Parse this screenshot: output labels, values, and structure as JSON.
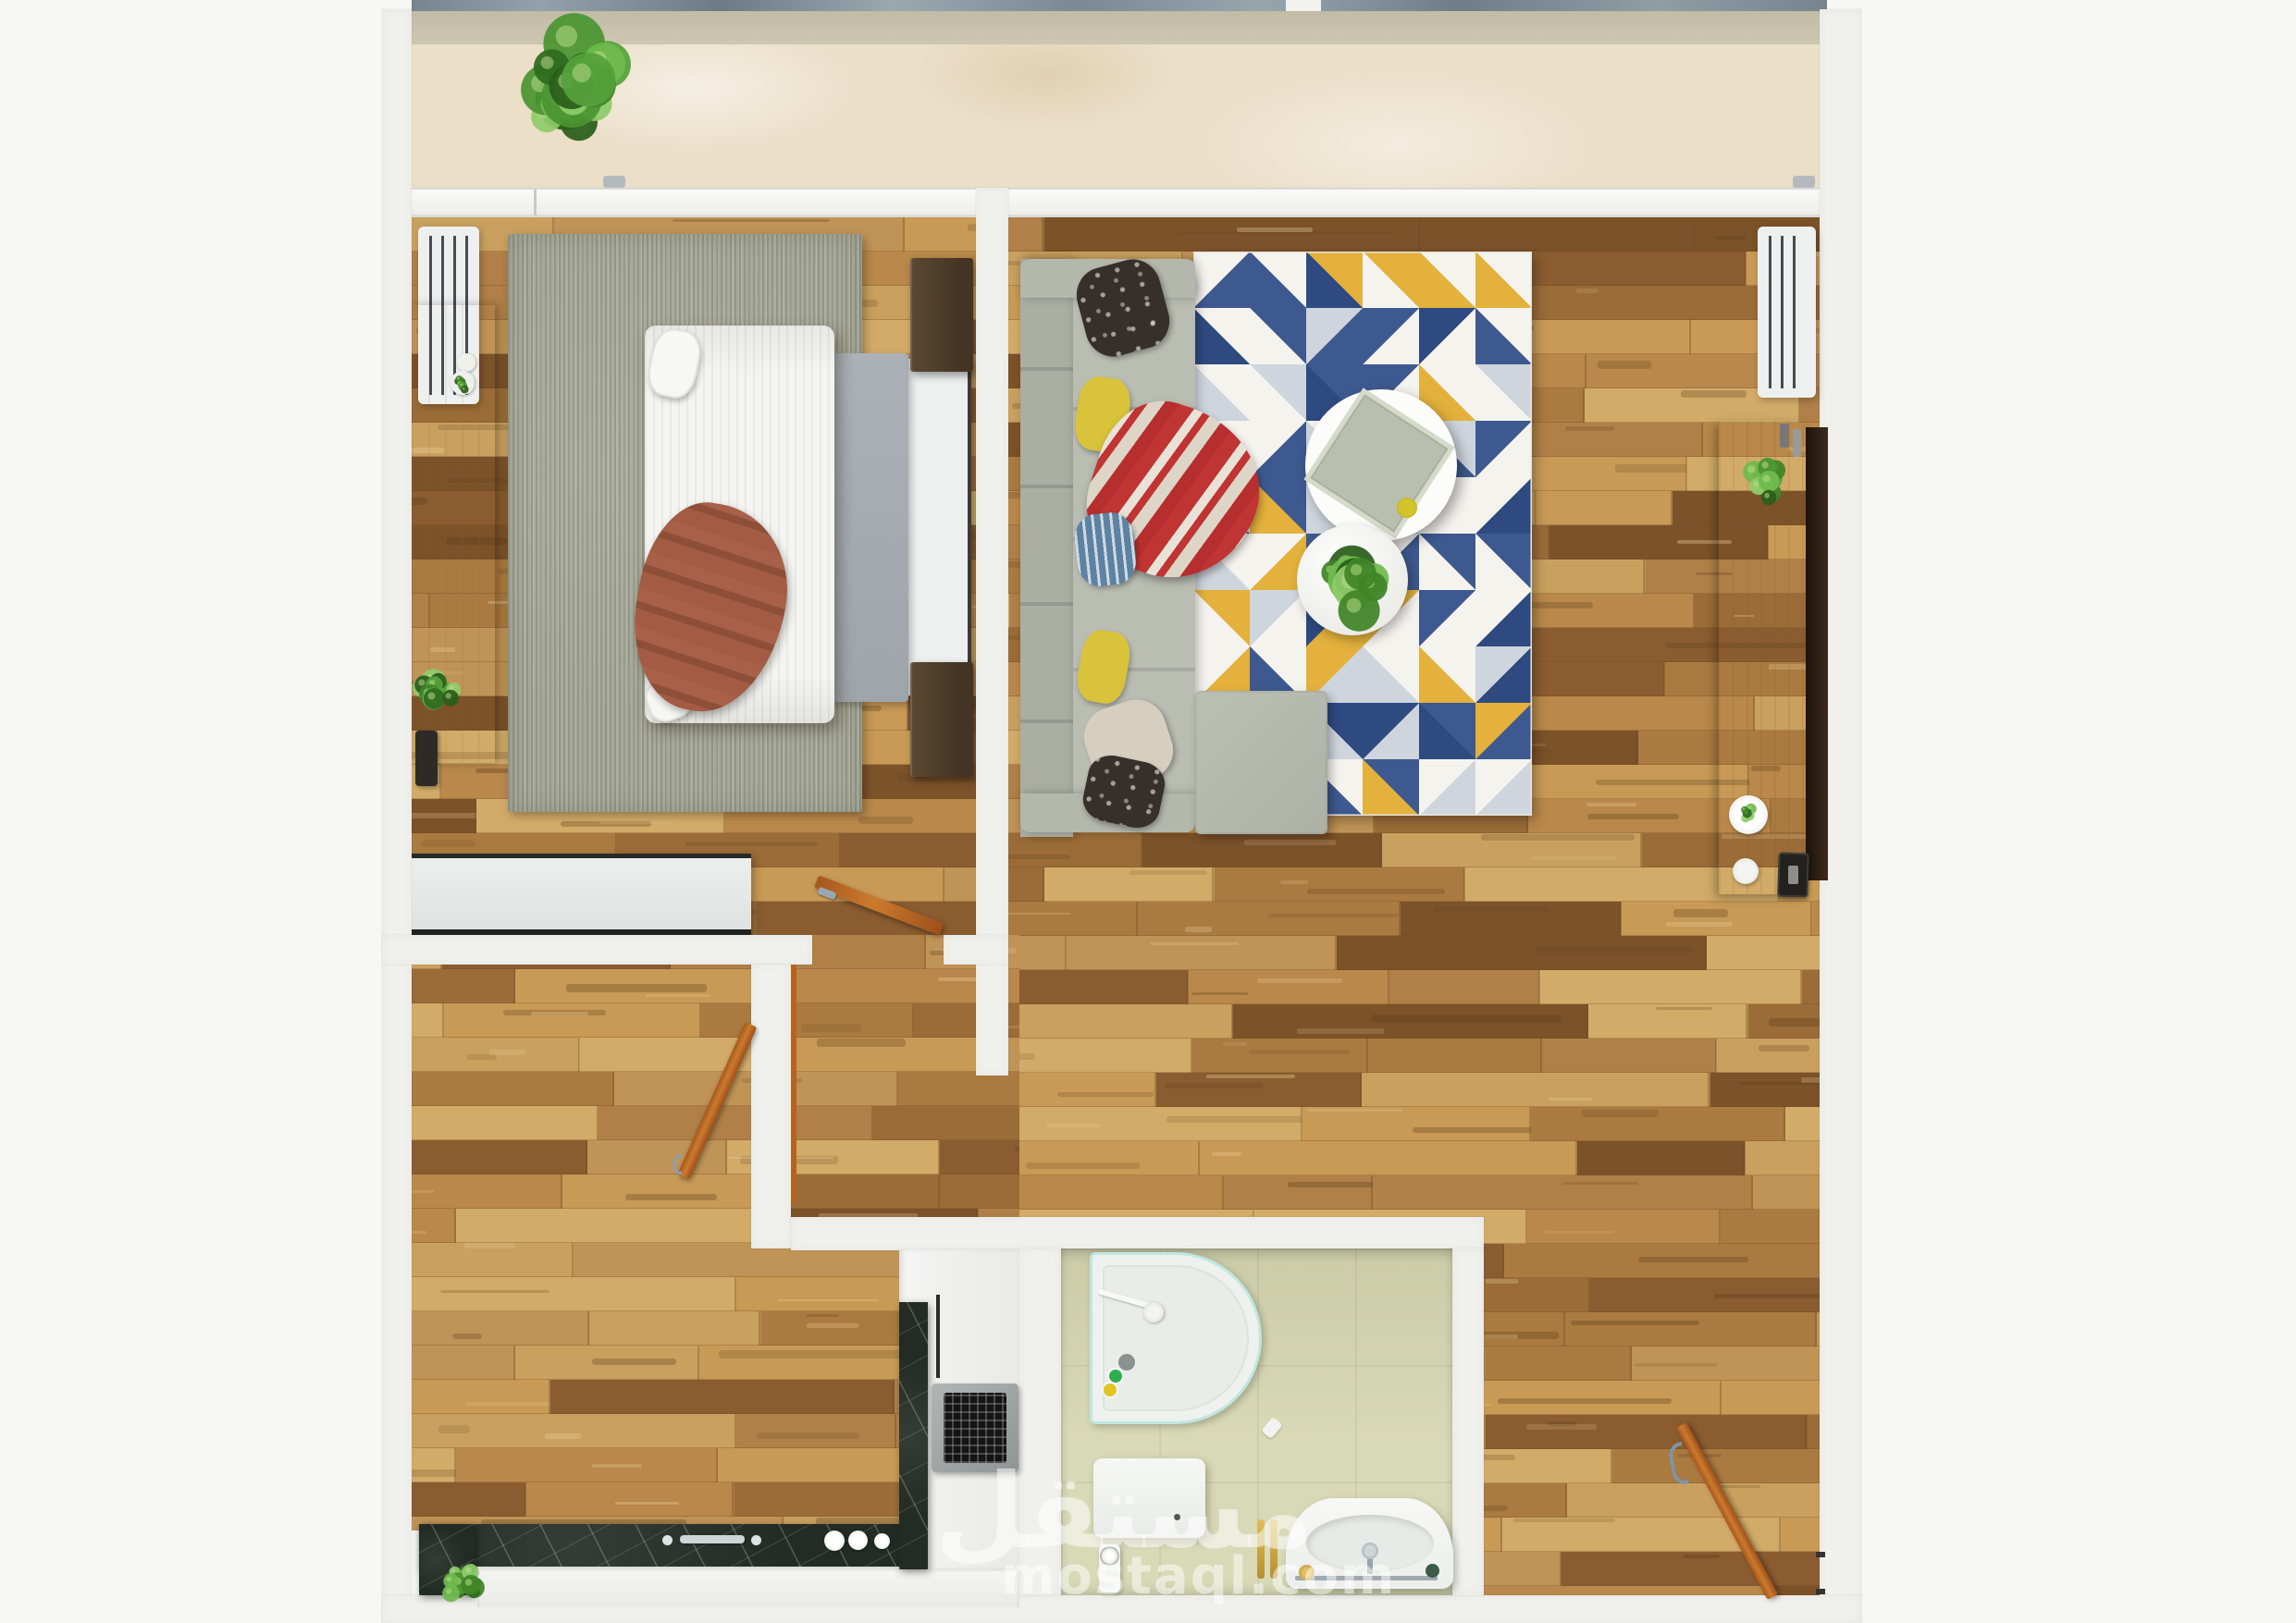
{
  "watermark": {
    "arabic": "مستقل",
    "latin": "mostaql.com"
  },
  "colors": {
    "bg": "#f7f7f4",
    "wall": "#f0f0ed",
    "balcony": "#ebdfc8",
    "ledge_stone": "#8795a0",
    "wood_light": "#c9a05e",
    "wood_dark": "#8a5c30",
    "bedroom_rug": "#a7aa99",
    "sofa": "#b7bab0",
    "rug_white": "#f4f3ee",
    "rug_blue": "#3e598f",
    "rug_blue_deep": "#2e4a80",
    "rug_gray": "#cfd5dd",
    "rug_yellow": "#e3b13c",
    "counter": "#222c24",
    "tile": "#d8d9b6",
    "door_wood": "#bb651f",
    "terracotta": "#9d5a41",
    "blanket_gray": "#a6acb2",
    "gold": "#c9a23c",
    "shower_aqua": "#9fdcd2",
    "plant_green": "#43892c"
  },
  "objects": [
    "balcony-plant-icon",
    "bedroom-radiator-icon",
    "bedroom-desk",
    "desk-plant-icon",
    "bedroom-rug",
    "double-bed",
    "bed-duvet",
    "bed-blanket",
    "bed-pillow",
    "throw-blanket",
    "nightstand",
    "dresser",
    "bedroom-door",
    "living-sofa",
    "sofa-pillow",
    "sofa-throw",
    "ottoman",
    "geometric-rug",
    "coffee-table",
    "serving-tray",
    "side-table",
    "table-plant-icon",
    "tv-console",
    "console-plant-icon",
    "tv-wall-panel",
    "living-radiator-icon",
    "kitchen-counter",
    "kitchen-sink-faucet",
    "stove-grate-icon",
    "counter-plant-icon",
    "kitchen-door",
    "shower-tray",
    "shower-head-icon",
    "toilet",
    "toilet-paper-holder-icon",
    "bathroom-sink",
    "towel-bar-icon",
    "entrance-door",
    "door-handle-icon",
    "window-sill",
    "window-handle-icon"
  ]
}
